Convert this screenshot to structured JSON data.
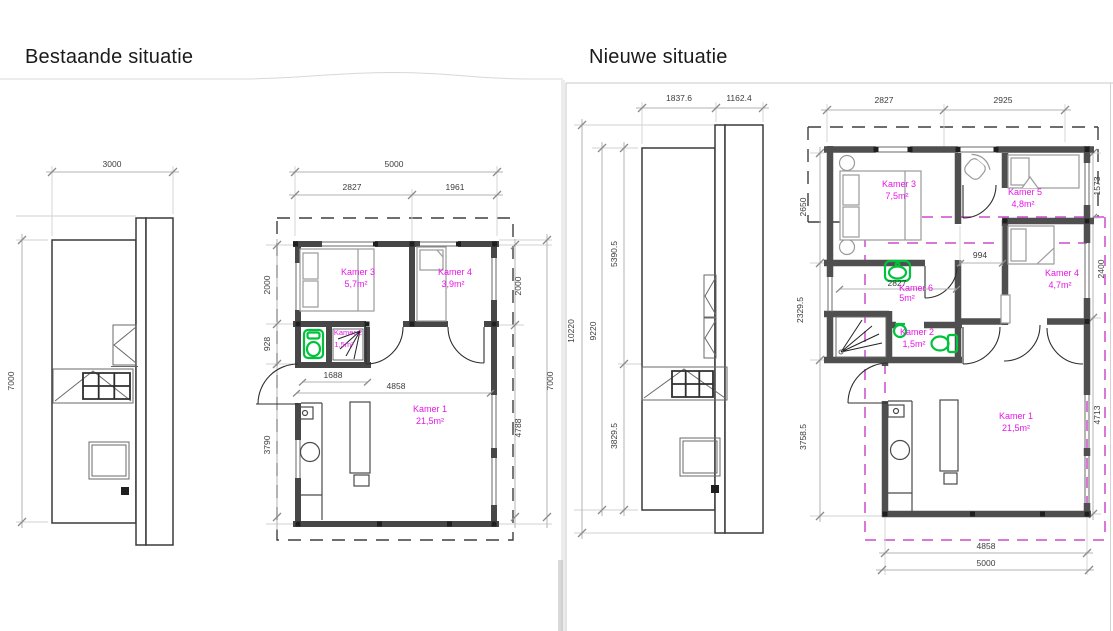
{
  "left": {
    "title": "Bestaande situatie",
    "elev": {
      "w": "3000",
      "h": "7000"
    },
    "plan": {
      "w_total": "5000",
      "w1": "2827",
      "w2": "1961",
      "l1": "2000",
      "l2": "928",
      "l3": "3790",
      "r1": "2000",
      "r2": "4788",
      "r_total": "7000",
      "i1": "1688",
      "i2": "4858",
      "k3": {
        "name": "Kamer 3",
        "area": "5,7m²"
      },
      "k4": {
        "name": "Kamer 4",
        "area": "3,9m²"
      },
      "k2": {
        "name": "Kamer 2",
        "area": "1,5m²"
      },
      "k1": {
        "name": "Kamer 1",
        "area": "21,5m²"
      }
    }
  },
  "right": {
    "title": "Nieuwe situatie",
    "elev": {
      "w1": "1837.6",
      "w2": "1162.4",
      "h1": "10220",
      "h2": "9220",
      "h3": "5390.5",
      "h4": "3829.5"
    },
    "plan": {
      "t1": "2827",
      "t2": "2925",
      "l1": "2650",
      "l2": "2329.5",
      "l3": "3758.5",
      "r1": "1573",
      "r2": "2400",
      "r3": "4713",
      "b1": "4858",
      "b2": "5000",
      "nook": "994",
      "inner": "2827",
      "k3": {
        "name": "Kamer 3",
        "area": "7,5m²"
      },
      "k5": {
        "name": "Kamer 5",
        "area": "4,8m²"
      },
      "k6": {
        "name": "Kamer 6",
        "area": "5m²"
      },
      "k4": {
        "name": "Kamer 4",
        "area": "4,7m²"
      },
      "k2": {
        "name": "Kamer 2",
        "area": "1,5m²"
      },
      "k1": {
        "name": "Kamer 1",
        "area": "21,5m²"
      }
    }
  },
  "colors": {
    "room_label": "#e816e8",
    "fixture_green": "#00c23c",
    "old_wall_dashed": "#cc4ccc",
    "wall": "#4a4a4a"
  }
}
